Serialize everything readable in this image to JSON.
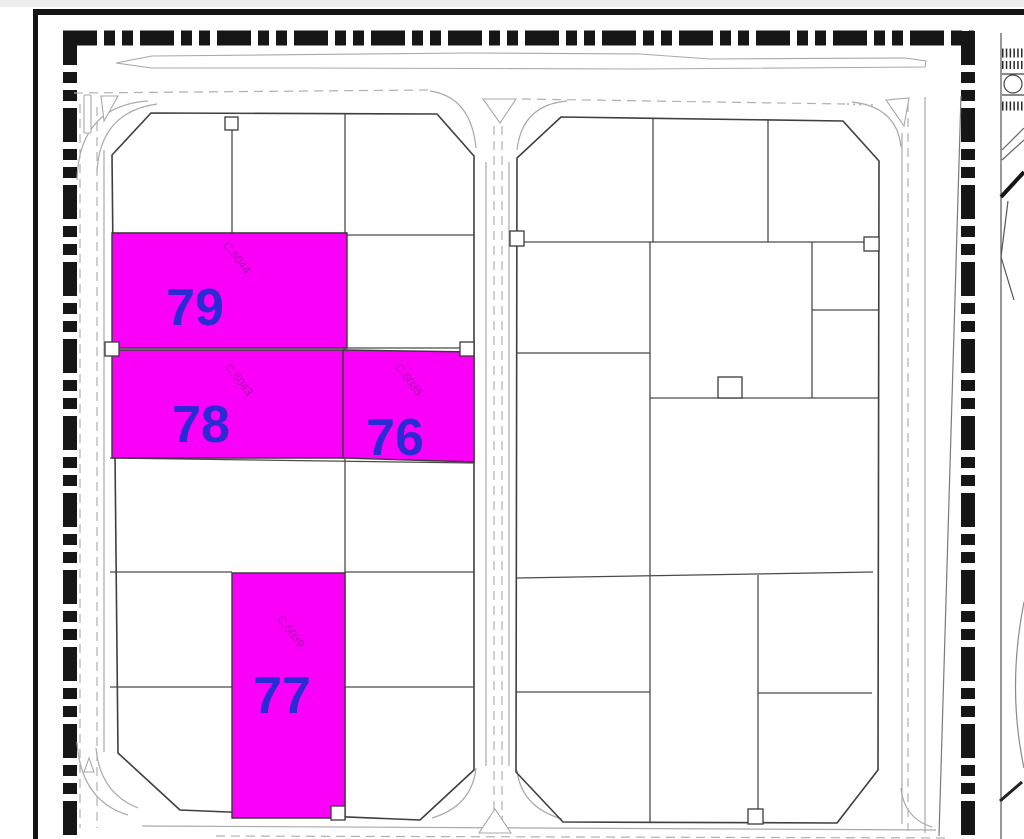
{
  "colors": {
    "parcel_highlight": "#FA00F8",
    "parcel_number": "#2B2BD5",
    "parcel_code": "#A511A5",
    "boundary_black": "#161616"
  },
  "parcels": [
    {
      "number": "79",
      "code": "C.6044"
    },
    {
      "number": "78",
      "code": "C.6043"
    },
    {
      "number": "76",
      "code": "C.6035"
    },
    {
      "number": "77",
      "code": "C.6039"
    }
  ]
}
